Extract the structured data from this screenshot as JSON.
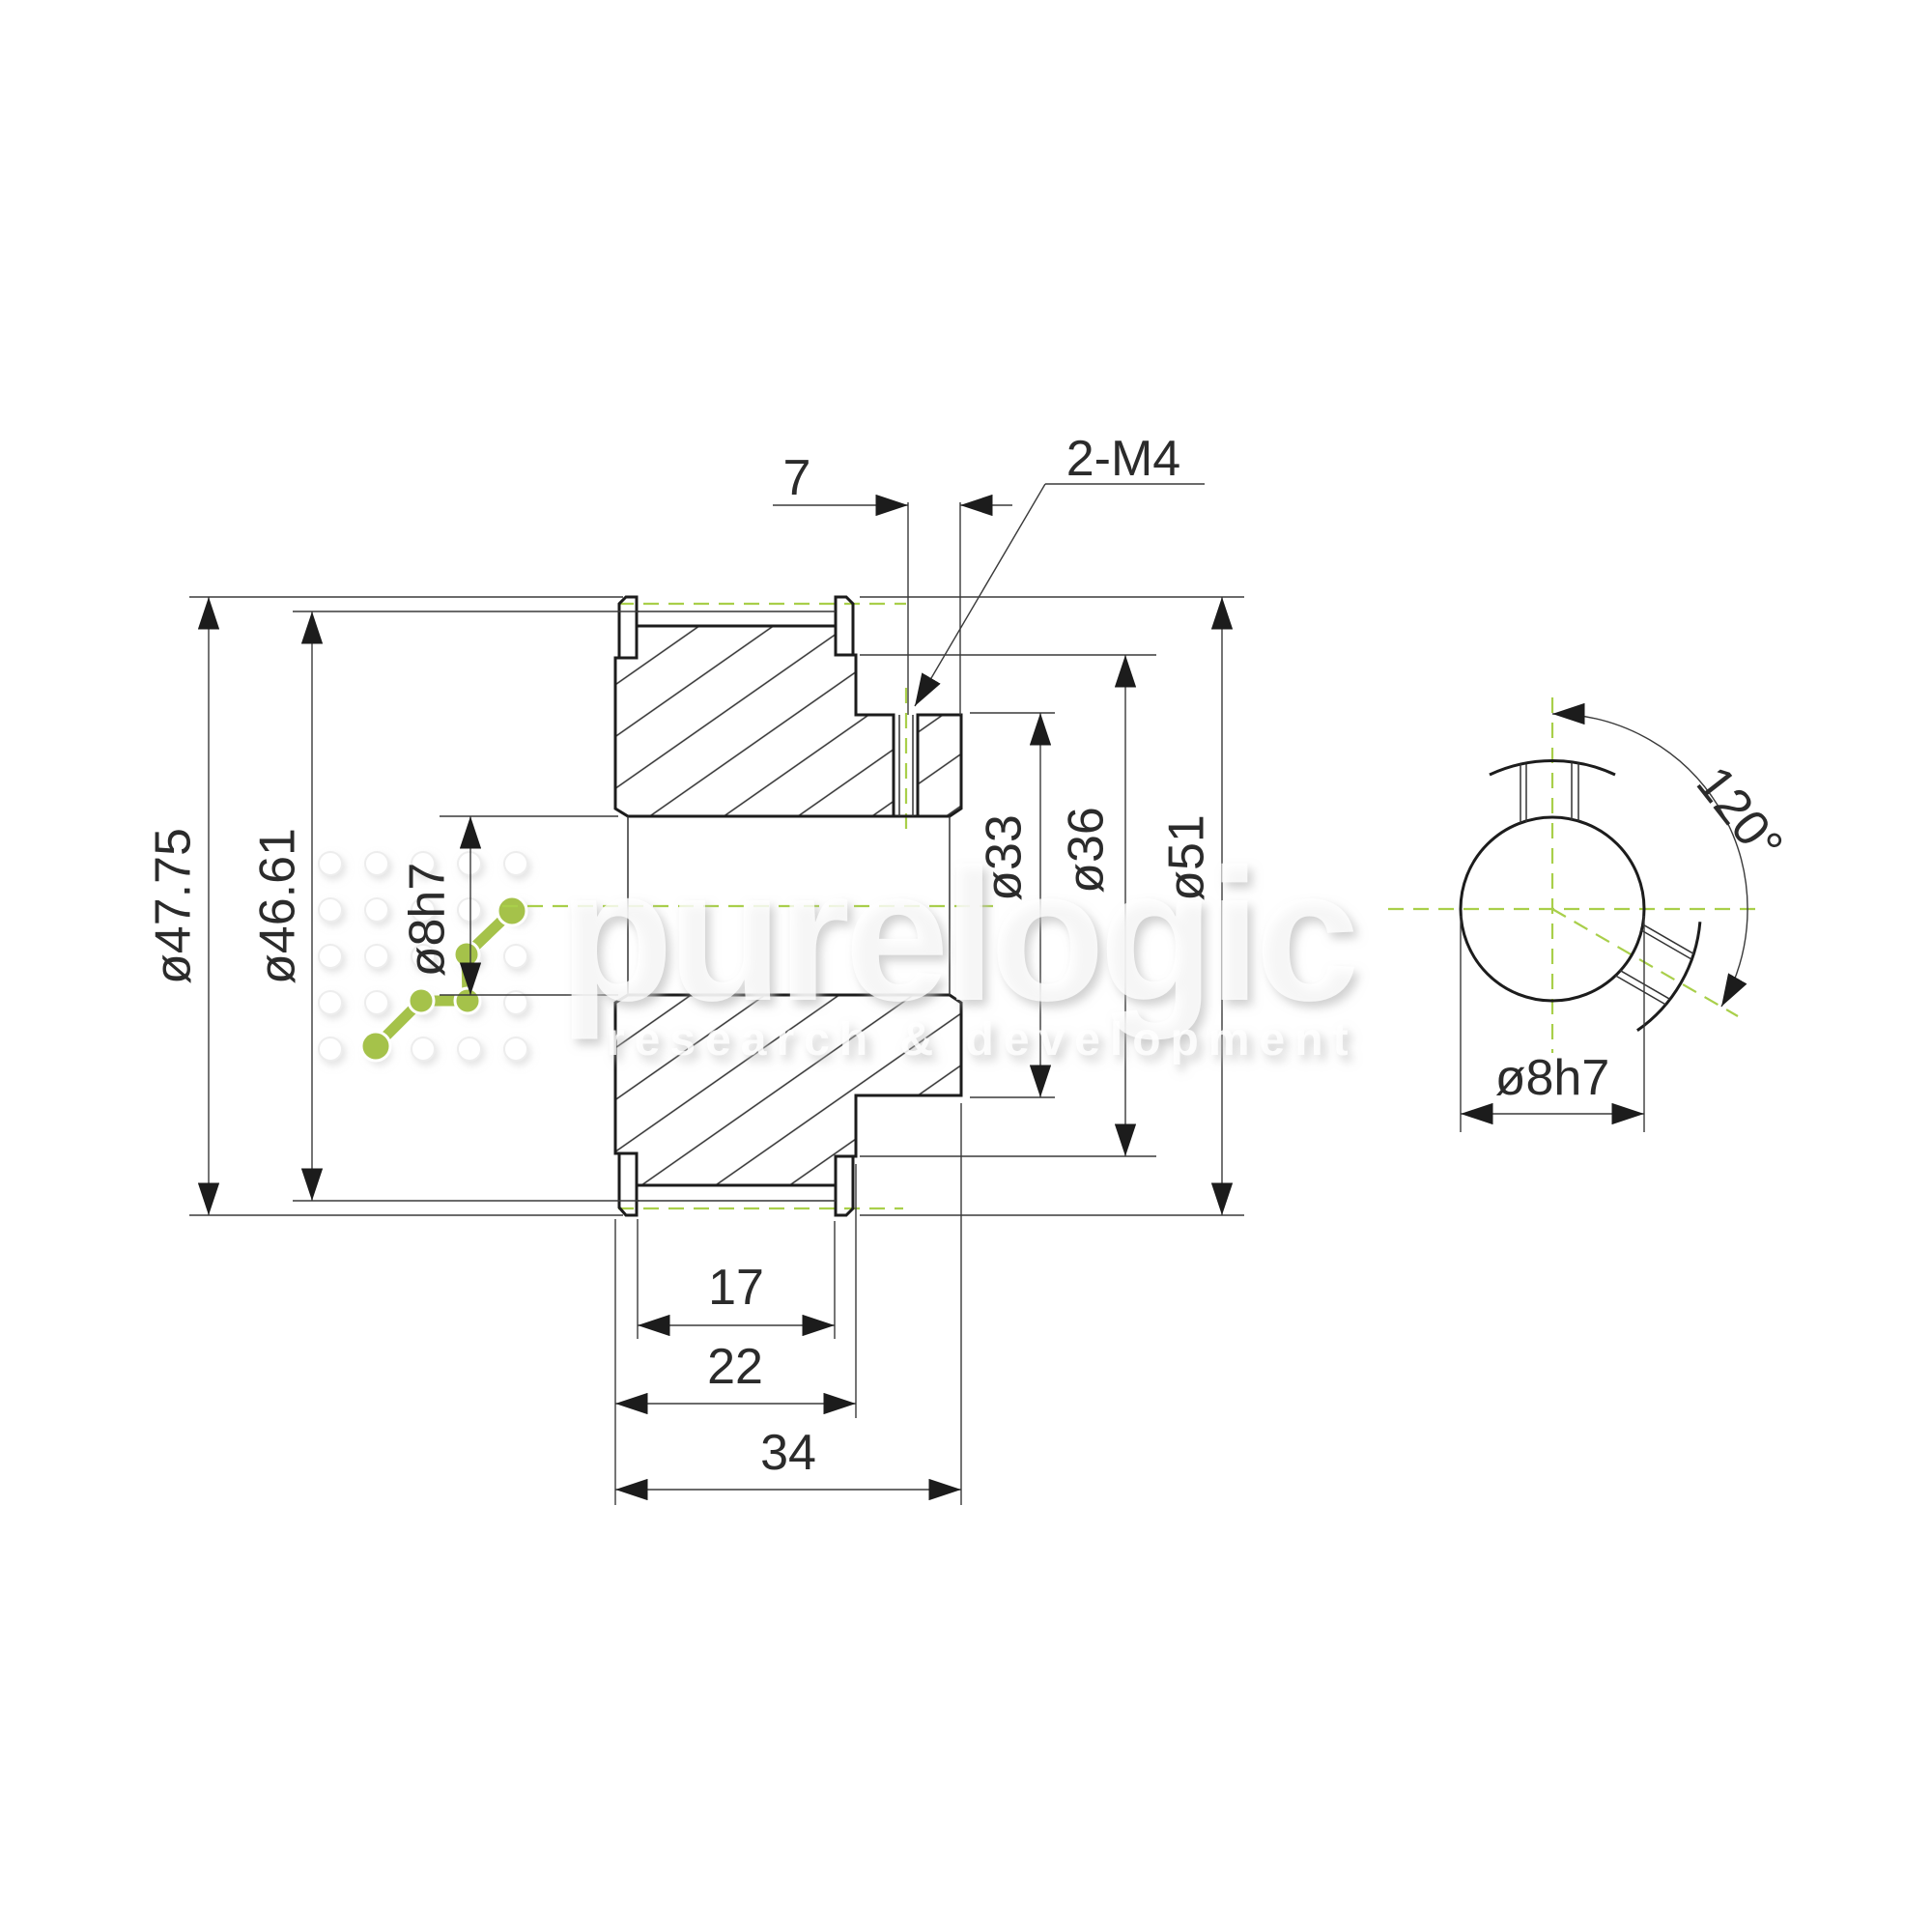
{
  "colors": {
    "centerline_green": "#a9cf4a",
    "logo_green": "#a5c24a",
    "line_color": "#1c1c1c"
  },
  "watermark": {
    "brand": "purelogic",
    "tagline": "research & development"
  },
  "section_view": {
    "dims": {
      "flange_diameter": "ø47.75",
      "tooth_tip_diameter": "ø46.61",
      "bore_diameter": "ø8h7",
      "setscrew_offset": "7",
      "setscrew_spec": "2-M4",
      "hub_diameter": "ø33",
      "shoulder_diameter": "ø36",
      "outer_diameter": "ø51",
      "belt_width": "17",
      "shoulder_width": "22",
      "overall_width": "34"
    }
  },
  "end_view": {
    "setscrew_angle": "120°",
    "bore_diameter": "ø8h7"
  }
}
